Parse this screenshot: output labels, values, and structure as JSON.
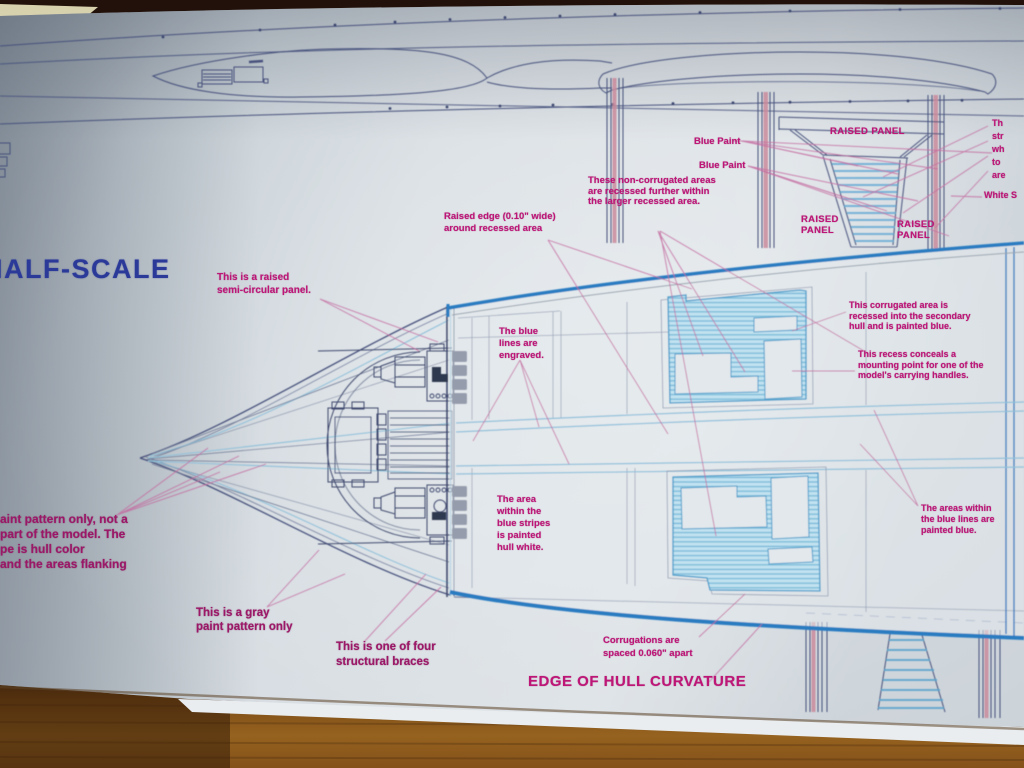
{
  "colors": {
    "paper": "#d6dce2",
    "wood": "#8a5a1e",
    "blueprint_line": "#46517c",
    "engraved_light_blue": "#8fc0da",
    "hull_edge_blue": "#2b7cc1",
    "corrugation_fill": "#c2e2f0",
    "corrugation_stroke": "#4f9dca",
    "annotation_magenta": "#bd1677",
    "title_blue": "#2b3a99",
    "leader_pink": "#c4699f"
  },
  "title": {
    "half_scale": "HALF-SCALE"
  },
  "annotations": {
    "raised_edge": "Raised edge (0.10\" wide)\naround recessed area",
    "non_corrugated": "These non-corrugated areas\nare recessed further within\nthe larger recessed area.",
    "blue_paint_1": "Blue Paint",
    "blue_paint_2": "Blue Paint",
    "raised_panel_top": "RAISED PANEL",
    "raised_panel_left": "RAISED\nPANEL",
    "raised_panel_right": "RAISED\nPANEL",
    "edge_text_clipped": "Th\nstr\nwh\nto\nare",
    "white_s": "White S",
    "semi_circular": "This is a raised\nsemi-circular panel.",
    "blue_lines_engraved": "The blue\nlines are\nengraved.",
    "left_clipped": "aint pattern only,  not a\npart of the model.  The\npe is hull color\n and the areas flanking",
    "area_within_stripes": "The area\nwithin the\nblue stripes\nis painted\nhull white.",
    "corrugated_recessed": "This corrugated area is\nrecessed into the secondary\nhull and is painted blue.",
    "recess_conceals": "This recess conceals a\nmounting point for one of the\nmodel's carrying handles.",
    "areas_within_blue": "The areas within\nthe blue lines are\npainted blue.",
    "gray_pattern": "This is a gray\npaint pattern only",
    "structural_braces": "This is one of four\nstructural braces",
    "corrugations_spaced": "Corrugations are\nspaced 0.060\" apart",
    "edge_of_hull": "EDGE OF HULL CURVATURE"
  }
}
